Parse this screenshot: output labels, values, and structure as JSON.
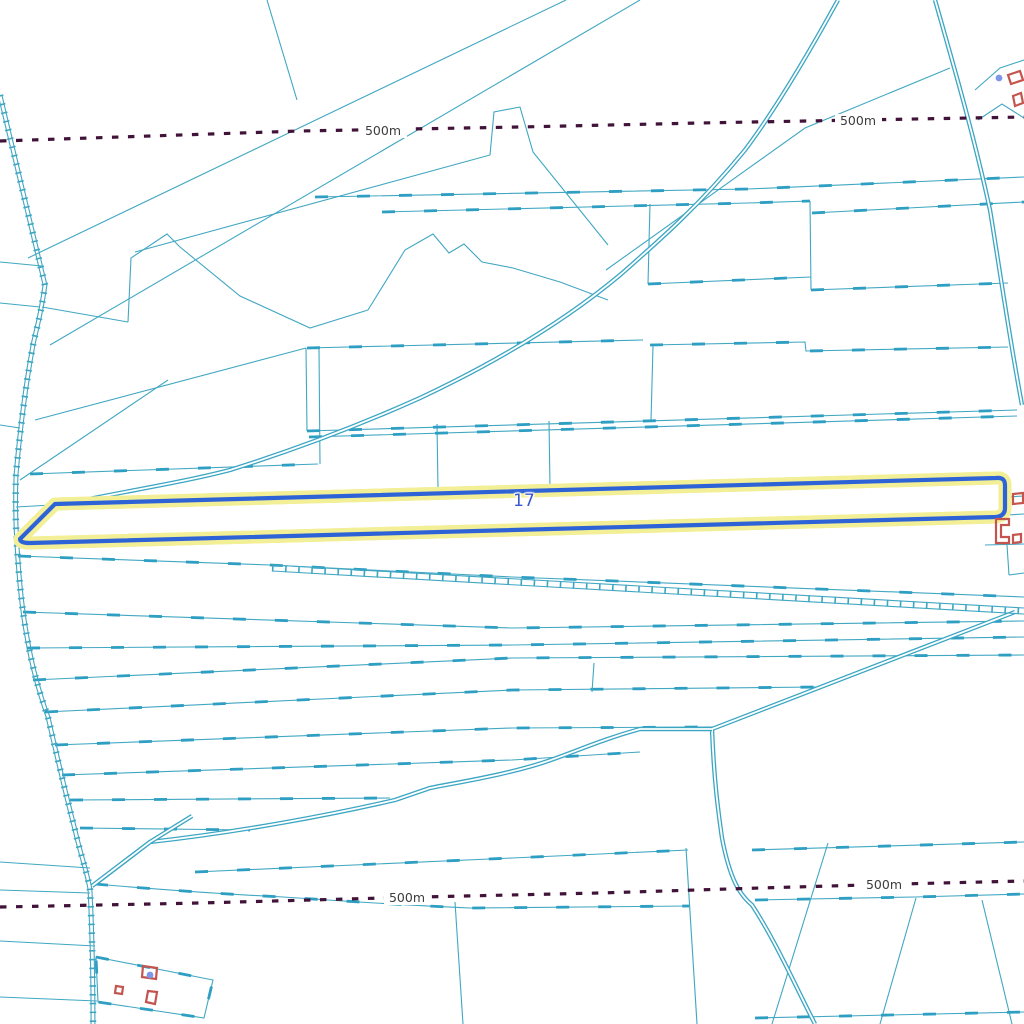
{
  "map": {
    "selected_parcel": {
      "label": "17",
      "outline_color": "#2e63d8",
      "halo_color": "#f2ef96",
      "label_color": "#3a58cf"
    },
    "contour_labels": [
      {
        "text": "500m",
        "x": 383,
        "y": 131
      },
      {
        "text": "500m",
        "x": 858,
        "y": 121
      },
      {
        "text": "500m",
        "x": 407,
        "y": 898
      },
      {
        "text": "500m",
        "x": 884,
        "y": 885
      }
    ],
    "colors": {
      "parcel_line": "#3ba6c3",
      "contour_line": "#421339",
      "contour_label_text": "#3d3d3d",
      "building_outline": "#c3544e",
      "point_marker": "#7e97e8",
      "background": "#ffffff"
    }
  }
}
